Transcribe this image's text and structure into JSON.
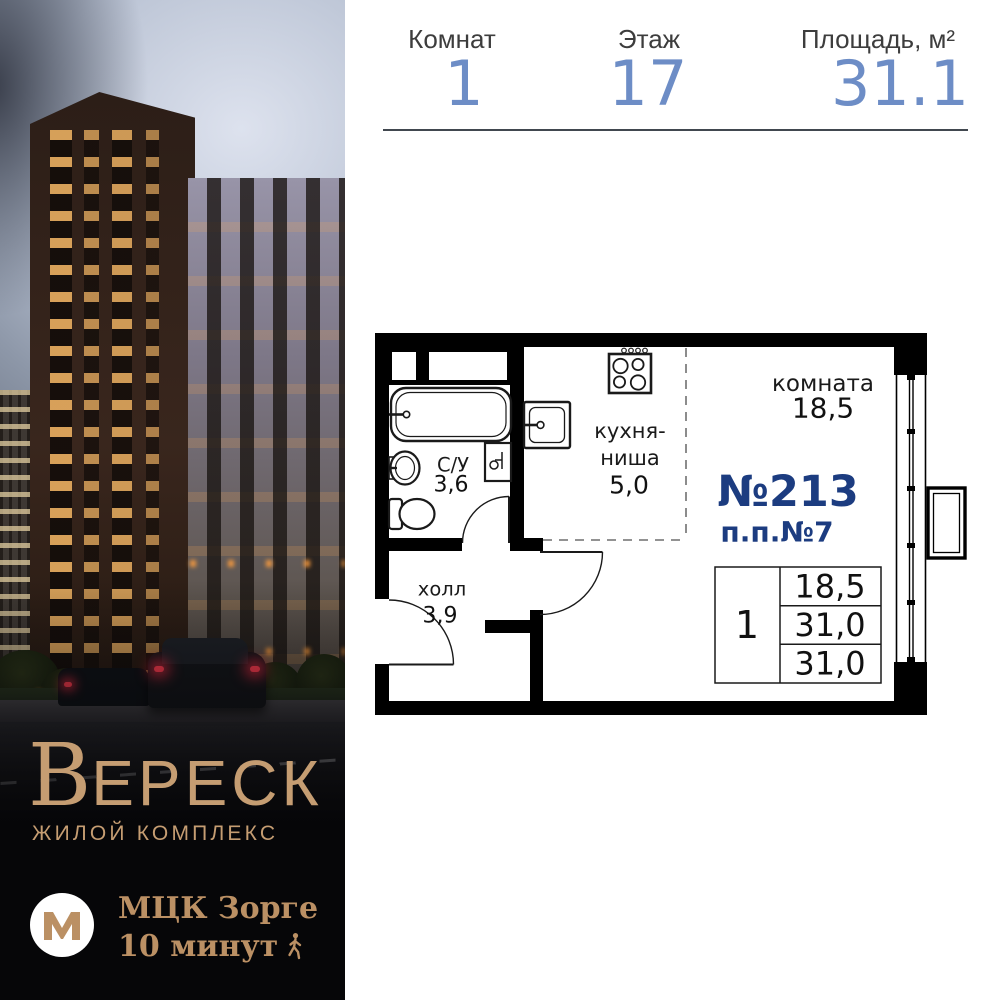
{
  "header": {
    "stats": [
      {
        "label": "Комнат",
        "value": "1"
      },
      {
        "label": "Этаж",
        "value": "17"
      },
      {
        "label": "Площадь, м²",
        "value": "31.1"
      }
    ]
  },
  "plan": {
    "rooms": {
      "living": {
        "label": "комната",
        "area": "18,5"
      },
      "kitchen": {
        "label_line1": "кухня-",
        "label_line2": "ниша",
        "area": "5,0"
      },
      "bathroom": {
        "label": "С/У",
        "area": "3,6"
      },
      "hall": {
        "label": "холл",
        "area": "3,9"
      }
    },
    "apartment_number": "№213",
    "plan_position": "п.п.№7",
    "spec_table": {
      "rooms_count": "1",
      "row1": "18,5",
      "row2": "31,0",
      "row3": "31,0"
    }
  },
  "brand": {
    "name_initial": "В",
    "name_rest": "ЕРЕСК",
    "subtitle": "ЖИЛОЙ КОМПЛЕКС"
  },
  "metro": {
    "symbol_icon": "metro-m-logo",
    "station": "МЦК Зорге",
    "walk_time": "10 минут"
  },
  "colors": {
    "value_blue": "#6d8dc6",
    "plan_navy": "#1c3c80",
    "brand_tan": "#c59d72",
    "plan_black": "#000000"
  }
}
